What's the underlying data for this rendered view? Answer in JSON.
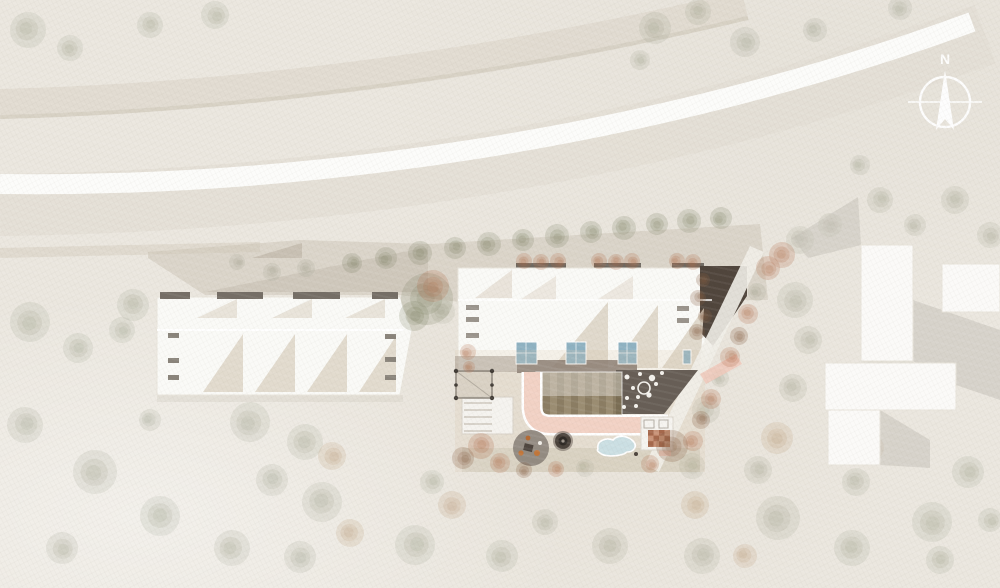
{
  "meta": {
    "title": "Architectural site plan — aerial view",
    "drawing_type": "site plan rendering"
  },
  "compass": {
    "label": "N"
  },
  "palette": {
    "paper": "#ebe7df",
    "road_ribbon": "#fcfcfa",
    "road_corridor": "#e3ded4",
    "upper_band": "#d9d2c5",
    "plaza": "#cbc3b6",
    "building_white": "#fafaf7",
    "roof_shade": "#ded6c8",
    "dark_bar": "#756e66",
    "glass_blue": "#8fb2c2",
    "dark_wedge": "#50453c",
    "terrace_dark": "#675e56",
    "path_pink": "#f2d2c5",
    "pool_blue": "#cbdfe3",
    "tile_terracotta": "#a5684c",
    "garden_stripe_a": "#9b8d72",
    "garden_stripe_b": "#7a6d54"
  },
  "tree_colors": {
    "s": "rgba(141,146,122,0.25)",
    "o": "rgba(120,123,94,0.38)",
    "r": "rgba(176,110,75,0.42)",
    "b": "rgba(133,92,64,0.45)",
    "t": "rgba(188,155,120,0.35)"
  },
  "trees": [
    [
      28,
      30,
      18,
      "s"
    ],
    [
      70,
      48,
      13,
      "s"
    ],
    [
      150,
      25,
      13,
      "s"
    ],
    [
      215,
      15,
      14,
      "s"
    ],
    [
      655,
      28,
      16,
      "s"
    ],
    [
      698,
      12,
      13,
      "s"
    ],
    [
      745,
      42,
      15,
      "s"
    ],
    [
      815,
      30,
      12,
      "s"
    ],
    [
      900,
      8,
      12,
      "s"
    ],
    [
      640,
      60,
      10,
      "s"
    ],
    [
      880,
      200,
      13,
      "s"
    ],
    [
      915,
      225,
      11,
      "s"
    ],
    [
      955,
      200,
      14,
      "s"
    ],
    [
      990,
      235,
      13,
      "s"
    ],
    [
      860,
      165,
      10,
      "s"
    ],
    [
      800,
      240,
      14,
      "s"
    ],
    [
      830,
      225,
      12,
      "s"
    ],
    [
      352,
      263,
      10,
      "o"
    ],
    [
      386,
      258,
      11,
      "o"
    ],
    [
      420,
      253,
      12,
      "o"
    ],
    [
      455,
      248,
      11,
      "o"
    ],
    [
      489,
      244,
      12,
      "o"
    ],
    [
      523,
      240,
      11,
      "o"
    ],
    [
      557,
      236,
      12,
      "o"
    ],
    [
      591,
      232,
      11,
      "o"
    ],
    [
      624,
      228,
      12,
      "o"
    ],
    [
      657,
      224,
      11,
      "o"
    ],
    [
      689,
      221,
      12,
      "o"
    ],
    [
      721,
      218,
      11,
      "o"
    ],
    [
      306,
      268,
      9,
      "s"
    ],
    [
      272,
      272,
      9,
      "s"
    ],
    [
      237,
      262,
      8,
      "s"
    ],
    [
      427,
      299,
      26,
      "o"
    ],
    [
      433,
      286,
      16,
      "r"
    ],
    [
      414,
      316,
      15,
      "o"
    ],
    [
      443,
      312,
      12,
      "s"
    ],
    [
      524,
      261,
      8,
      "r"
    ],
    [
      541,
      262,
      8,
      "r"
    ],
    [
      558,
      261,
      8,
      "r"
    ],
    [
      599,
      261,
      8,
      "r"
    ],
    [
      616,
      262,
      8,
      "r"
    ],
    [
      632,
      261,
      8,
      "r"
    ],
    [
      677,
      261,
      8,
      "r"
    ],
    [
      693,
      262,
      8,
      "r"
    ],
    [
      703,
      280,
      7,
      "b"
    ],
    [
      698,
      298,
      8,
      "b"
    ],
    [
      705,
      316,
      7,
      "b"
    ],
    [
      697,
      332,
      8,
      "b"
    ],
    [
      768,
      268,
      12,
      "r"
    ],
    [
      757,
      292,
      9,
      "s"
    ],
    [
      748,
      314,
      10,
      "r"
    ],
    [
      739,
      336,
      9,
      "b"
    ],
    [
      730,
      357,
      10,
      "r"
    ],
    [
      720,
      378,
      9,
      "s"
    ],
    [
      711,
      399,
      10,
      "r"
    ],
    [
      701,
      420,
      9,
      "b"
    ],
    [
      693,
      441,
      10,
      "r"
    ],
    [
      782,
      255,
      13,
      "r"
    ],
    [
      795,
      300,
      18,
      "s"
    ],
    [
      808,
      340,
      14,
      "s"
    ],
    [
      793,
      388,
      14,
      "s"
    ],
    [
      777,
      438,
      16,
      "t"
    ],
    [
      758,
      470,
      14,
      "s"
    ],
    [
      468,
      352,
      8,
      "r"
    ],
    [
      469,
      367,
      6,
      "r"
    ],
    [
      481,
      446,
      13,
      "r"
    ],
    [
      463,
      458,
      11,
      "b"
    ],
    [
      500,
      463,
      10,
      "r"
    ],
    [
      524,
      470,
      8,
      "b"
    ],
    [
      556,
      469,
      8,
      "r"
    ],
    [
      585,
      468,
      9,
      "s"
    ],
    [
      672,
      446,
      16,
      "b"
    ],
    [
      692,
      466,
      13,
      "s"
    ],
    [
      650,
      464,
      9,
      "r"
    ],
    [
      706,
      410,
      14,
      "s"
    ],
    [
      133,
      305,
      16,
      "s"
    ],
    [
      122,
      330,
      13,
      "s"
    ],
    [
      150,
      420,
      11,
      "s"
    ],
    [
      30,
      322,
      20,
      "s"
    ],
    [
      78,
      348,
      15,
      "s"
    ],
    [
      25,
      425,
      18,
      "s"
    ],
    [
      95,
      472,
      22,
      "s"
    ],
    [
      160,
      516,
      20,
      "s"
    ],
    [
      62,
      548,
      16,
      "s"
    ],
    [
      232,
      548,
      18,
      "s"
    ],
    [
      322,
      502,
      20,
      "s"
    ],
    [
      300,
      557,
      16,
      "s"
    ],
    [
      415,
      545,
      20,
      "s"
    ],
    [
      502,
      556,
      16,
      "s"
    ],
    [
      610,
      546,
      18,
      "s"
    ],
    [
      702,
      556,
      18,
      "s"
    ],
    [
      778,
      518,
      22,
      "s"
    ],
    [
      852,
      548,
      18,
      "s"
    ],
    [
      932,
      522,
      20,
      "s"
    ],
    [
      968,
      472,
      16,
      "s"
    ],
    [
      856,
      482,
      14,
      "s"
    ],
    [
      545,
      522,
      13,
      "s"
    ],
    [
      432,
      482,
      12,
      "s"
    ],
    [
      250,
      422,
      20,
      "s"
    ],
    [
      305,
      442,
      18,
      "s"
    ],
    [
      272,
      480,
      16,
      "s"
    ],
    [
      332,
      456,
      14,
      "t"
    ],
    [
      350,
      533,
      14,
      "t"
    ],
    [
      452,
      505,
      14,
      "t"
    ],
    [
      695,
      505,
      14,
      "t"
    ],
    [
      745,
      556,
      12,
      "t"
    ],
    [
      872,
      448,
      12,
      "t"
    ],
    [
      940,
      560,
      14,
      "s"
    ],
    [
      990,
      520,
      12,
      "s"
    ]
  ]
}
